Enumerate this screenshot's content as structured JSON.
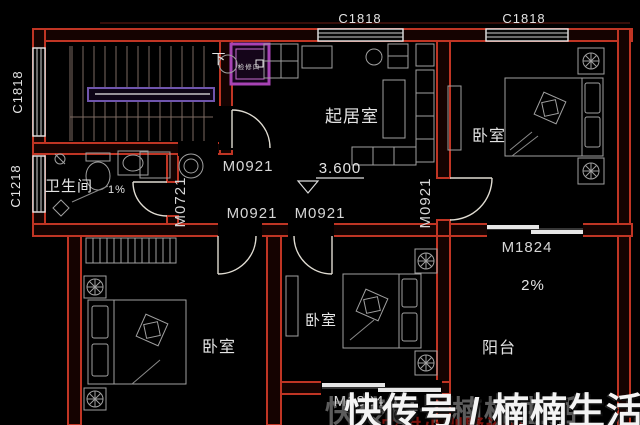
{
  "colors": {
    "background": "#000000",
    "wall_red": "#c03524",
    "window_white": "#e8e8e8",
    "furniture_gray": "#a0a0a0",
    "hatch_purple": "#a843b5",
    "stair_rail_purple": "#6f55ad",
    "label_text": "#e4e4e4",
    "watermark_white": "#f4f4f4",
    "watermark_red": "#7d130e"
  },
  "plan": {
    "rooms": {
      "living_room": "起居室",
      "bedroom_top_right": "卧室",
      "bedroom_bottom_left": "卧室",
      "bedroom_bottom_middle": "卧室",
      "bathroom": "卫生间",
      "balcony": "阳台"
    },
    "windows": {
      "top_1": "C1818",
      "top_2": "C1818",
      "left_top": "C1818",
      "left_bottom": "C1218"
    },
    "doors": {
      "hall_to_living": "M0921",
      "bathroom": "M0721",
      "corridor_left": "M0921",
      "corridor_right": "M0921",
      "bedroom_right": "M0921",
      "balcony_right": "M1824",
      "balcony_bottom": "M1824"
    },
    "annotations": {
      "floor_elevation": "3.600",
      "bathroom_slope": "1%",
      "balcony_slope": "2%",
      "stair_direction": "下",
      "access_panel": "检修口"
    }
  },
  "watermark": {
    "main": "快传号 / 楠楠生活",
    "sub": "农村小别墅设计"
  }
}
